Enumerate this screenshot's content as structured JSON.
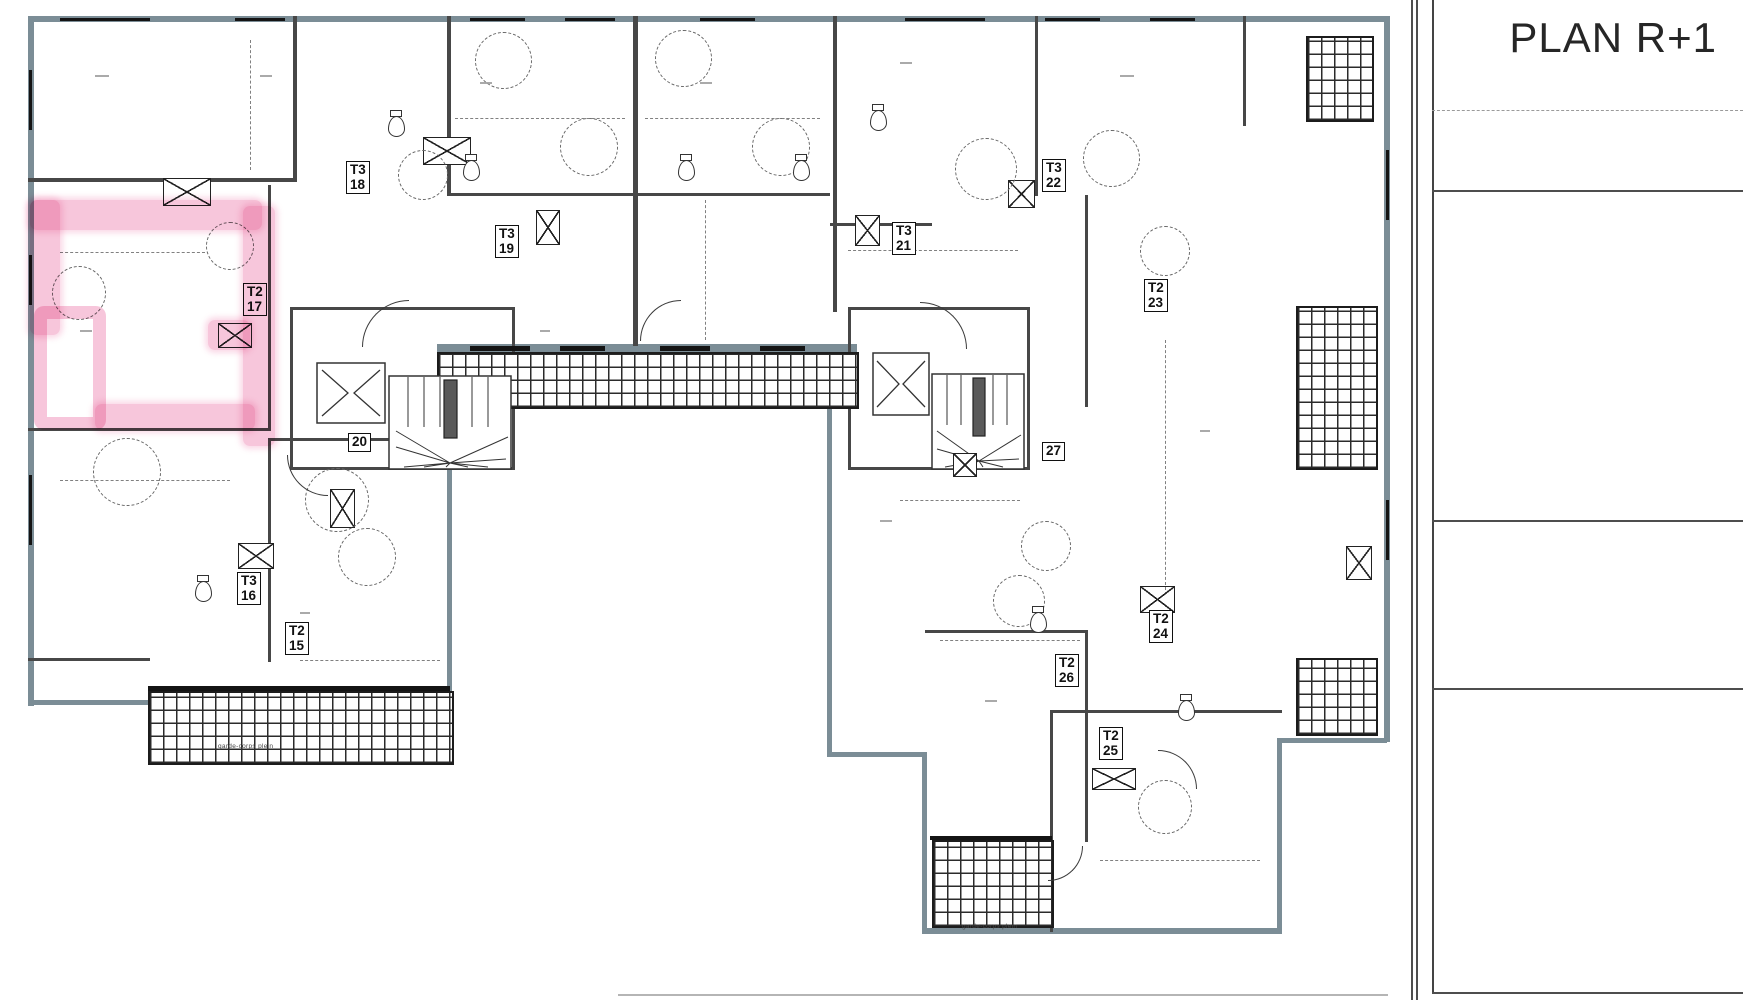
{
  "title_block": {
    "title": "PLAN R+1"
  },
  "plan": {
    "highlight_color": "#ed76aa",
    "highlighted_unit": "T2 17",
    "balcony_caption": "garde-corps plein",
    "units": [
      {
        "type": "T3",
        "num": "18"
      },
      {
        "type": "T3",
        "num": "19"
      },
      {
        "type": "T2",
        "num": "17"
      },
      {
        "type": "",
        "num": "20"
      },
      {
        "type": "T3",
        "num": "16"
      },
      {
        "type": "T2",
        "num": "15"
      },
      {
        "type": "T3",
        "num": "22"
      },
      {
        "type": "T3",
        "num": "21"
      },
      {
        "type": "T2",
        "num": "23"
      },
      {
        "type": "",
        "num": "27"
      },
      {
        "type": "T2",
        "num": "24"
      },
      {
        "type": "T2",
        "num": "26"
      },
      {
        "type": "T2",
        "num": "25"
      }
    ]
  }
}
